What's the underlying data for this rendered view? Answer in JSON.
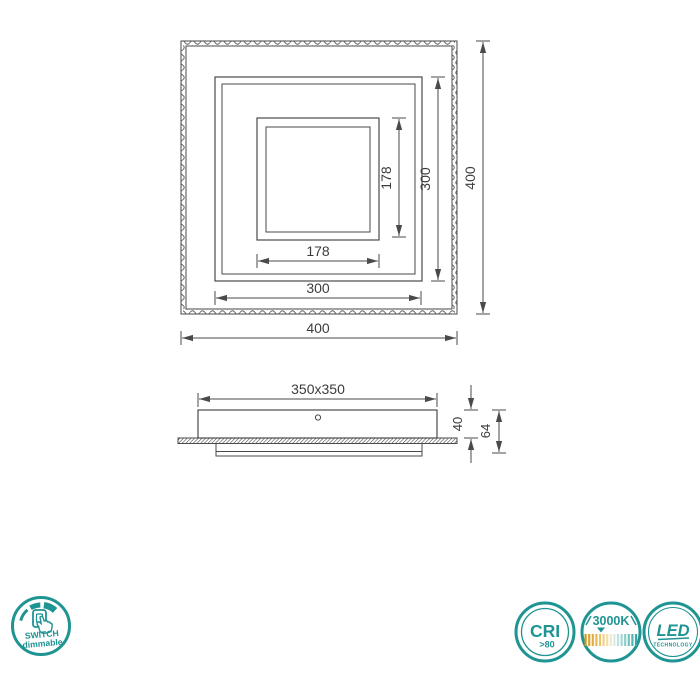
{
  "colors": {
    "accent_teal": "#1E9493",
    "drawing_line": "#4a4a4a",
    "dimension_text": "#3c3c3c",
    "warm_white_bar": "#DFA72E",
    "cool_bar": "#5CB8B5"
  },
  "top_view": {
    "outer_width": "400",
    "outer_height": "400",
    "middle_width": "300",
    "middle_height": "300",
    "inner_width": "178",
    "inner_height": "178"
  },
  "side_view": {
    "base": "350x350",
    "body_height": "40",
    "total_height": "64"
  },
  "badges": {
    "switch": {
      "line1": "SWITCH",
      "line2": "dimmable"
    },
    "cri": {
      "title": "CRI",
      "value": ">80"
    },
    "kelvin": {
      "title": "3000K"
    },
    "led": {
      "title": "LED",
      "subtitle": "TECHNOLOGY"
    }
  }
}
